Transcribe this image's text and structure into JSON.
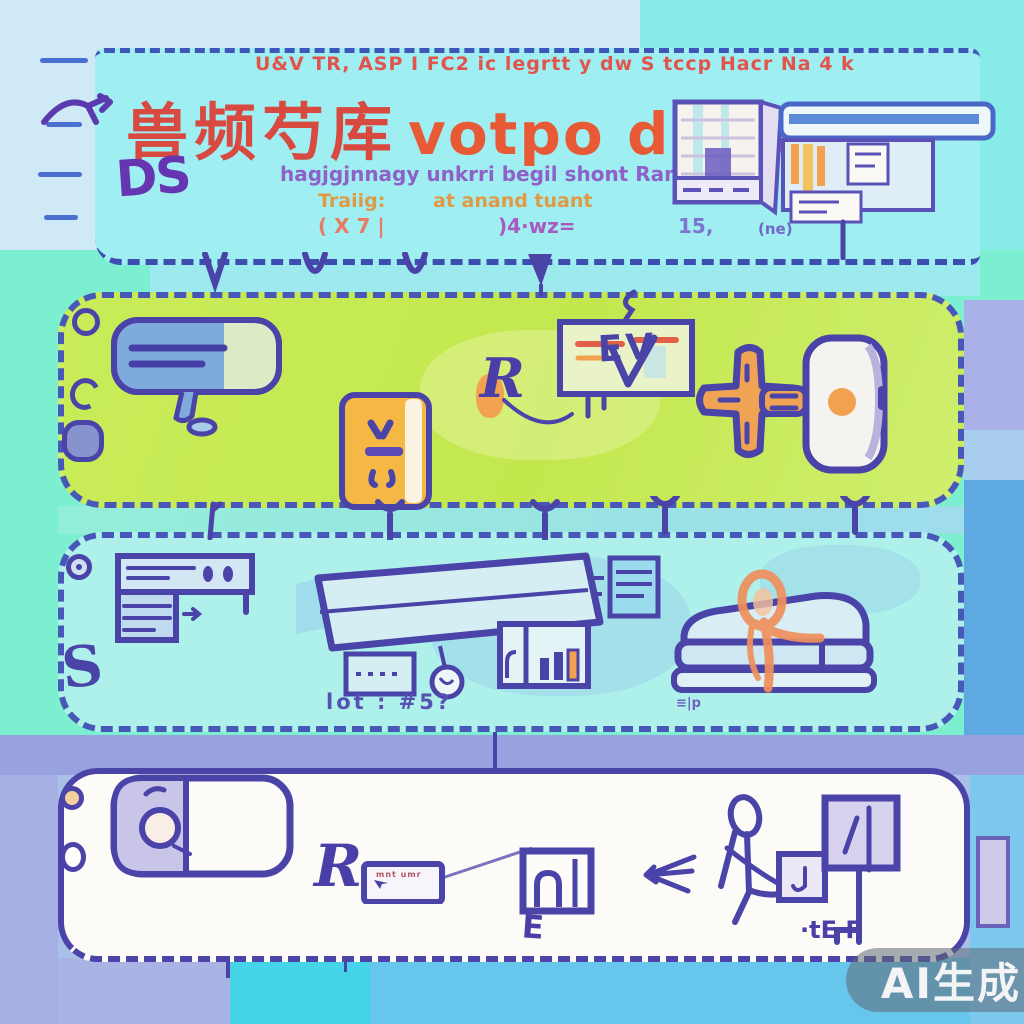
{
  "palette": {
    "ink": "#4a43a8",
    "title_red": "#d8493f",
    "accent_orange": "#f2a24e",
    "header_fill": "#9feef1",
    "green_panel_fill": "#c9ec59",
    "cyan_panel_fill": "#aef0ea",
    "white_panel_fill": "#fcfbf7",
    "band_periwinkle": "#98a2df",
    "aquamarine": "#7cefd0",
    "steel_blue": "#5fa9e3",
    "sky_blue": "#7cc8ee"
  },
  "header": {
    "topline": "U&V TR, ASP I FC2 ic legrtt y dw S tccp Hacr Na 4 k",
    "title_cjk": "兽频芍库",
    "title_latin": "votpo ddnd",
    "badge": "DS",
    "subtitle": "hagjgjnnagy unkrri begil shont Ramt",
    "col1": {
      "label": "Traiig:",
      "value": "( X 7 |"
    },
    "col2": {
      "label": "at anand tuant",
      "value": ")4·wz="
    },
    "stat": {
      "value": "15,",
      "note": "(ne)"
    },
    "sketch_icons": [
      "calendar-grid",
      "toolbar-bar",
      "orange-bars-card",
      "note-cards"
    ]
  },
  "green_panel": {
    "window_letters": "EV",
    "r_scribble": "R",
    "icons": [
      "ring-icon",
      "c-shape-icon",
      "nut-icon",
      "speech-bubble-icon",
      "power-bank-icon",
      "r-scribble-icon",
      "browser-window-icon",
      "plus-cross-icon",
      "smart-speaker-icon"
    ]
  },
  "middle_panel": {
    "s_label": "S",
    "caption": "lot : #5?",
    "caption2": "≡|p",
    "icons": [
      "dial-icon",
      "desk-server-icon",
      "paper-sheet-icon",
      "tag-pendant-icon",
      "dotted-box-icon",
      "bar-chart-house-icon",
      "server-stack-icon",
      "sofa-bow-icon"
    ]
  },
  "bottom_panel": {
    "r_label": "R",
    "e_label": "E",
    "scribble": "·tE Γ",
    "card_text": "mnt umr",
    "icons": [
      "washer-device-icon",
      "note-card-icon",
      "monitor-box-icon",
      "left-arrow-icon",
      "stick-figure-icon",
      "squares-icon"
    ]
  },
  "watermark": {
    "label": "AI生成"
  }
}
